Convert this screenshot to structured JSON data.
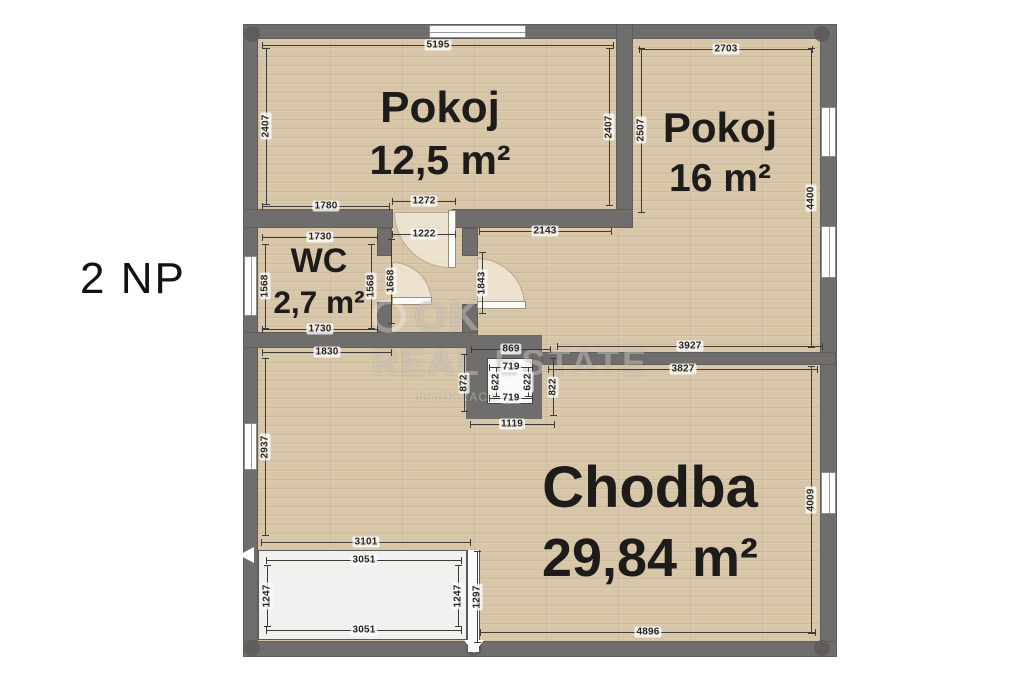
{
  "floor_label": "2 NP",
  "rooms": [
    {
      "name": "Pokoj",
      "area": "12,5 m²"
    },
    {
      "name": "Pokoj",
      "area": "16 m²"
    },
    {
      "name": "WC",
      "area": "2,7 m²"
    },
    {
      "name": "Chodba",
      "area": "29,84 m²"
    }
  ],
  "watermark": {
    "logo": "OK",
    "brand": "REAL ESTATE",
    "tagline": "demOKRACIE"
  },
  "colors": {
    "wall": "#706e6c",
    "floor_wood": "#d8c6a8",
    "dim_text": "#2a2722"
  },
  "dimensions_mm": [
    {
      "label": "5195",
      "x": 438,
      "y": 45,
      "len": 352,
      "dir": "h"
    },
    {
      "label": "2703",
      "x": 726,
      "y": 49,
      "len": 174,
      "dir": "h"
    },
    {
      "label": "2407",
      "x": 266,
      "y": 126,
      "len": 157,
      "dir": "v"
    },
    {
      "label": "2407",
      "x": 609,
      "y": 127,
      "len": 158,
      "dir": "v"
    },
    {
      "label": "2507",
      "x": 641,
      "y": 130,
      "len": 165,
      "dir": "v"
    },
    {
      "label": "1780",
      "x": 326,
      "y": 206,
      "len": 128,
      "dir": "h"
    },
    {
      "label": "1272",
      "x": 424,
      "y": 201,
      "len": 64,
      "dir": "h"
    },
    {
      "label": "1222",
      "x": 424,
      "y": 234,
      "len": 64,
      "dir": "h"
    },
    {
      "label": "2143",
      "x": 545,
      "y": 231,
      "len": 133,
      "dir": "h"
    },
    {
      "label": "1730",
      "x": 320,
      "y": 237,
      "len": 116,
      "dir": "h"
    },
    {
      "label": "1568",
      "x": 265,
      "y": 286,
      "len": 85,
      "dir": "v"
    },
    {
      "label": "1568",
      "x": 371,
      "y": 286,
      "len": 85,
      "dir": "v"
    },
    {
      "label": "1668",
      "x": 391,
      "y": 281,
      "len": 85,
      "dir": "v"
    },
    {
      "label": "1843",
      "x": 482,
      "y": 283,
      "len": 62,
      "dir": "v"
    },
    {
      "label": "1730",
      "x": 320,
      "y": 329,
      "len": 116,
      "dir": "h"
    },
    {
      "label": "1830",
      "x": 327,
      "y": 352,
      "len": 130,
      "dir": "h"
    },
    {
      "label": "869",
      "x": 511,
      "y": 349,
      "len": 80,
      "dir": "h"
    },
    {
      "label": "719",
      "x": 511,
      "y": 367,
      "len": 44,
      "dir": "h"
    },
    {
      "label": "622",
      "x": 496,
      "y": 382,
      "len": 30,
      "dir": "v"
    },
    {
      "label": "622",
      "x": 528,
      "y": 382,
      "len": 30,
      "dir": "v"
    },
    {
      "label": "719",
      "x": 511,
      "y": 398,
      "len": 44,
      "dir": "h"
    },
    {
      "label": "872",
      "x": 464,
      "y": 383,
      "len": 58,
      "dir": "v"
    },
    {
      "label": "822",
      "x": 553,
      "y": 387,
      "len": 58,
      "dir": "v"
    },
    {
      "label": "1119",
      "x": 512,
      "y": 424,
      "len": 85,
      "dir": "h"
    },
    {
      "label": "3927",
      "x": 690,
      "y": 346,
      "len": 266,
      "dir": "h"
    },
    {
      "label": "3827",
      "x": 683,
      "y": 369,
      "len": 270,
      "dir": "h"
    },
    {
      "label": "4400",
      "x": 811,
      "y": 198,
      "len": 300,
      "dir": "v"
    },
    {
      "label": "4009",
      "x": 811,
      "y": 500,
      "len": 268,
      "dir": "v"
    },
    {
      "label": "2937",
      "x": 265,
      "y": 447,
      "len": 178,
      "dir": "v"
    },
    {
      "label": "3101",
      "x": 366,
      "y": 542,
      "len": 210,
      "dir": "h"
    },
    {
      "label": "3051",
      "x": 364,
      "y": 560,
      "len": 196,
      "dir": "h"
    },
    {
      "label": "1247",
      "x": 267,
      "y": 596,
      "len": 62,
      "dir": "v"
    },
    {
      "label": "1247",
      "x": 458,
      "y": 596,
      "len": 62,
      "dir": "v"
    },
    {
      "label": "1297",
      "x": 477,
      "y": 597,
      "len": 92,
      "dir": "v"
    },
    {
      "label": "3051",
      "x": 364,
      "y": 630,
      "len": 196,
      "dir": "h"
    },
    {
      "label": "4896",
      "x": 648,
      "y": 632,
      "len": 336,
      "dir": "h"
    }
  ]
}
